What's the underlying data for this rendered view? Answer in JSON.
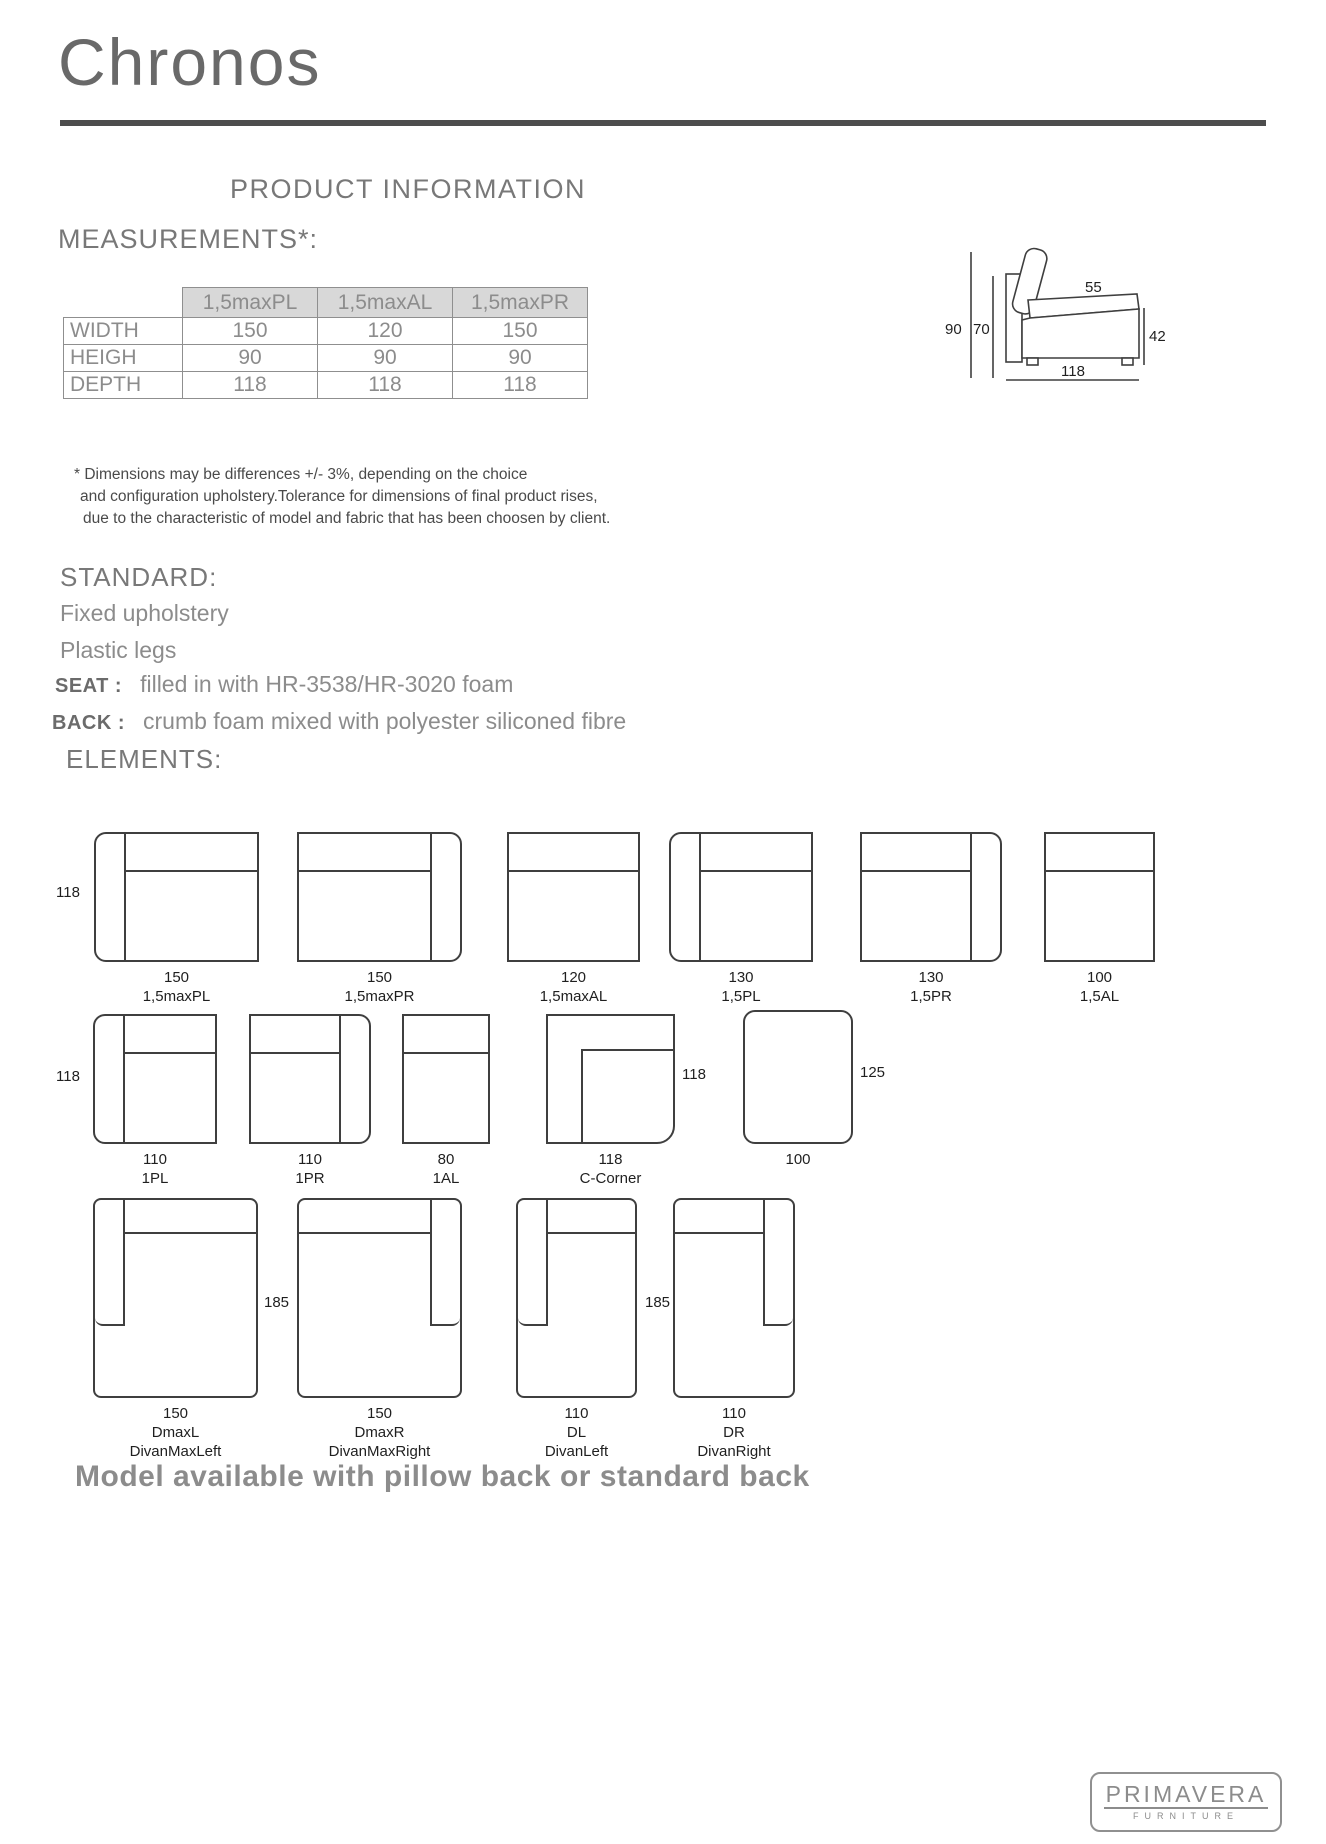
{
  "header": {
    "title": "Chronos",
    "product_information": "PRODUCT INFORMATION"
  },
  "measurements": {
    "heading": "MEASUREMENTS*:",
    "table": {
      "columns": [
        "1,5maxPL",
        "1,5maxAL",
        "1,5maxPR"
      ],
      "rows": [
        {
          "label": "WIDTH",
          "values": [
            "150",
            "120",
            "150"
          ]
        },
        {
          "label": "HEIGH",
          "values": [
            "90",
            "90",
            "90"
          ]
        },
        {
          "label": "DEPTH",
          "values": [
            "118",
            "118",
            "118"
          ]
        }
      ]
    },
    "disclaimer": [
      "* Dimensions may be differences +/- 3%, depending on the choice",
      "and configuration upholstery.Tolerance for dimensions of final product rises,",
      "due to the characteristic of model and fabric that has been choosen by client."
    ]
  },
  "side_diagram": {
    "total_height": "90",
    "seat_height": "70",
    "seat_depth": "55",
    "arm_height": "42",
    "total_depth": "118"
  },
  "standard": {
    "heading": "STANDARD:",
    "items": [
      "Fixed upholstery",
      "Plastic legs"
    ],
    "seat_label": "SEAT :",
    "seat_value": "filled in with HR-3538/HR-3020 foam",
    "back_label": "BACK :",
    "back_value": "crumb foam mixed with polyester siliconed fibre"
  },
  "elements": {
    "heading": "ELEMENTS:",
    "row1": {
      "depth": "118",
      "items": [
        {
          "width": "150",
          "code": "1,5maxPL"
        },
        {
          "width": "150",
          "code": "1,5maxPR"
        },
        {
          "width": "120",
          "code": "1,5maxAL"
        },
        {
          "width": "130",
          "code": "1,5PL"
        },
        {
          "width": "130",
          "code": "1,5PR"
        },
        {
          "width": "100",
          "code": "1,5AL"
        }
      ]
    },
    "row2": {
      "depth": "118",
      "items": [
        {
          "width": "110",
          "code": "1PL"
        },
        {
          "width": "110",
          "code": "1PR"
        },
        {
          "width": "80",
          "code": "1AL"
        }
      ],
      "corner": {
        "width": "118",
        "code": "C-Corner",
        "side": "118"
      },
      "ottoman": {
        "width": "100",
        "side": "125"
      }
    },
    "row3": {
      "length_a": "185",
      "length_b": "185",
      "items": [
        {
          "width": "150",
          "code": "DmaxL",
          "name": "DivanMaxLeft"
        },
        {
          "width": "150",
          "code": "DmaxR",
          "name": "DivanMaxRight"
        },
        {
          "width": "110",
          "code": "DL",
          "name": "DivanLeft"
        },
        {
          "width": "110",
          "code": "DR",
          "name": "DivanRight"
        }
      ]
    }
  },
  "note": "Model available with pillow back or standard back",
  "logo": {
    "brand": "PRIMAVERA",
    "sub": "FURNITURE"
  }
}
